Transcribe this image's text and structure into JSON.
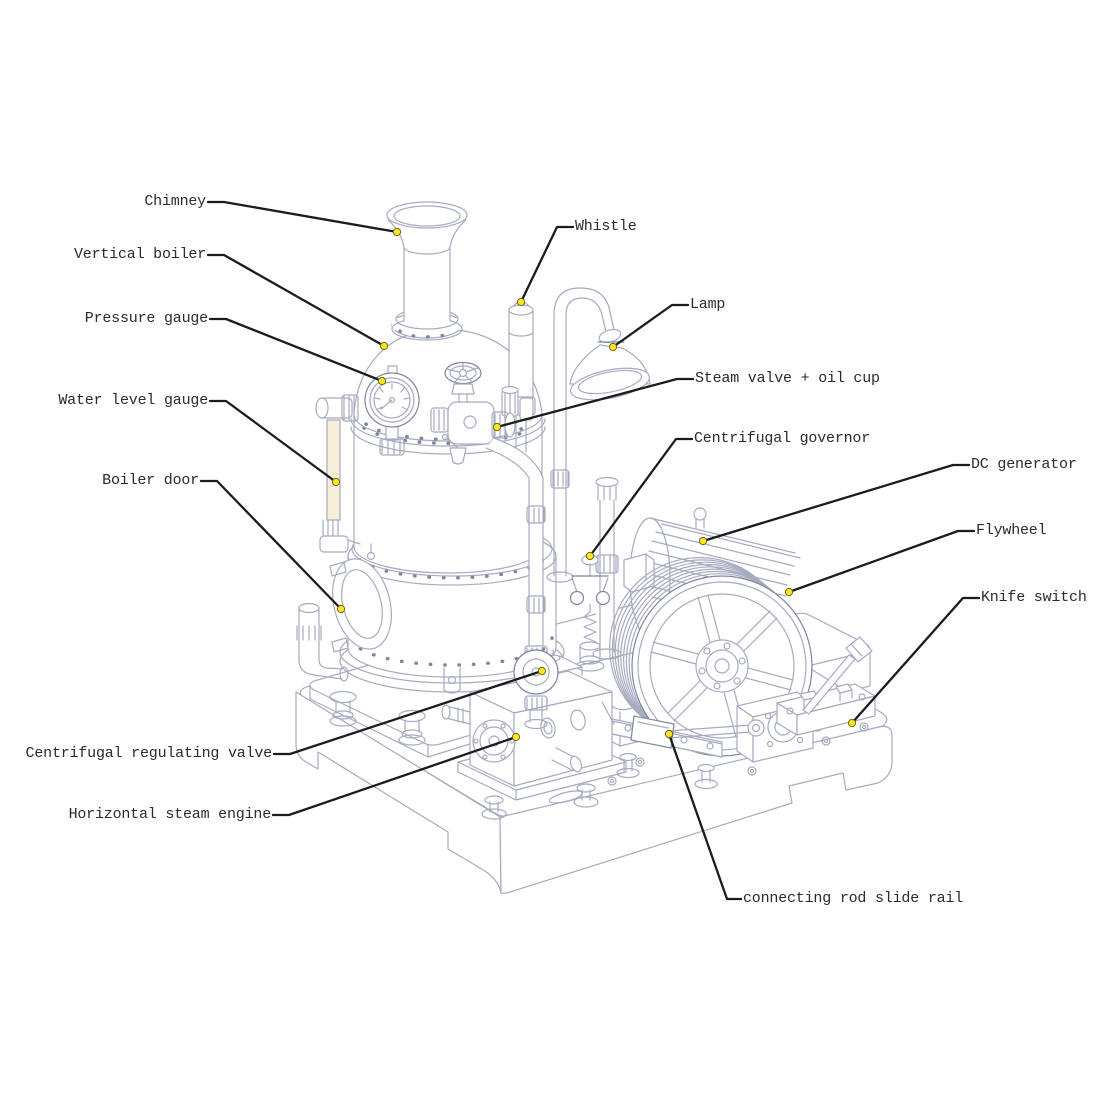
{
  "diagram": {
    "labels": [
      {
        "id": "chimney",
        "text": "Chimney",
        "side": "left"
      },
      {
        "id": "vertical-boiler",
        "text": "Vertical boiler",
        "side": "left"
      },
      {
        "id": "pressure-gauge",
        "text": "Pressure gauge",
        "side": "left"
      },
      {
        "id": "water-level-gauge",
        "text": "Water level gauge",
        "side": "left"
      },
      {
        "id": "boiler-door",
        "text": "Boiler door",
        "side": "left"
      },
      {
        "id": "centrifugal-regulating-valve",
        "text": "Centrifugal regulating valve",
        "side": "left"
      },
      {
        "id": "horizontal-steam-engine",
        "text": "Horizontal steam engine",
        "side": "left"
      },
      {
        "id": "whistle",
        "text": "Whistle",
        "side": "right"
      },
      {
        "id": "lamp",
        "text": "Lamp",
        "side": "right"
      },
      {
        "id": "steam-valve-oil-cup",
        "text": "Steam valve + oil cup",
        "side": "right"
      },
      {
        "id": "centrifugal-governor",
        "text": "Centrifugal governor",
        "side": "right"
      },
      {
        "id": "dc-generator",
        "text": "DC generator",
        "side": "right"
      },
      {
        "id": "flywheel",
        "text": "Flywheel",
        "side": "right"
      },
      {
        "id": "knife-switch",
        "text": "Knife switch",
        "side": "right"
      },
      {
        "id": "connecting-rod-slide-rail",
        "text": "connecting rod slide rail",
        "side": "right"
      }
    ],
    "colors": {
      "background": "#ffffff",
      "drawing_line": "#a6abc0",
      "drawing_line_dark": "#7e86a0",
      "leader_line": "#1c1c1c",
      "callout_dot": "#ffe71f",
      "gauge_tube": "#f7efd8",
      "label_text": "#2b2b2b"
    }
  }
}
